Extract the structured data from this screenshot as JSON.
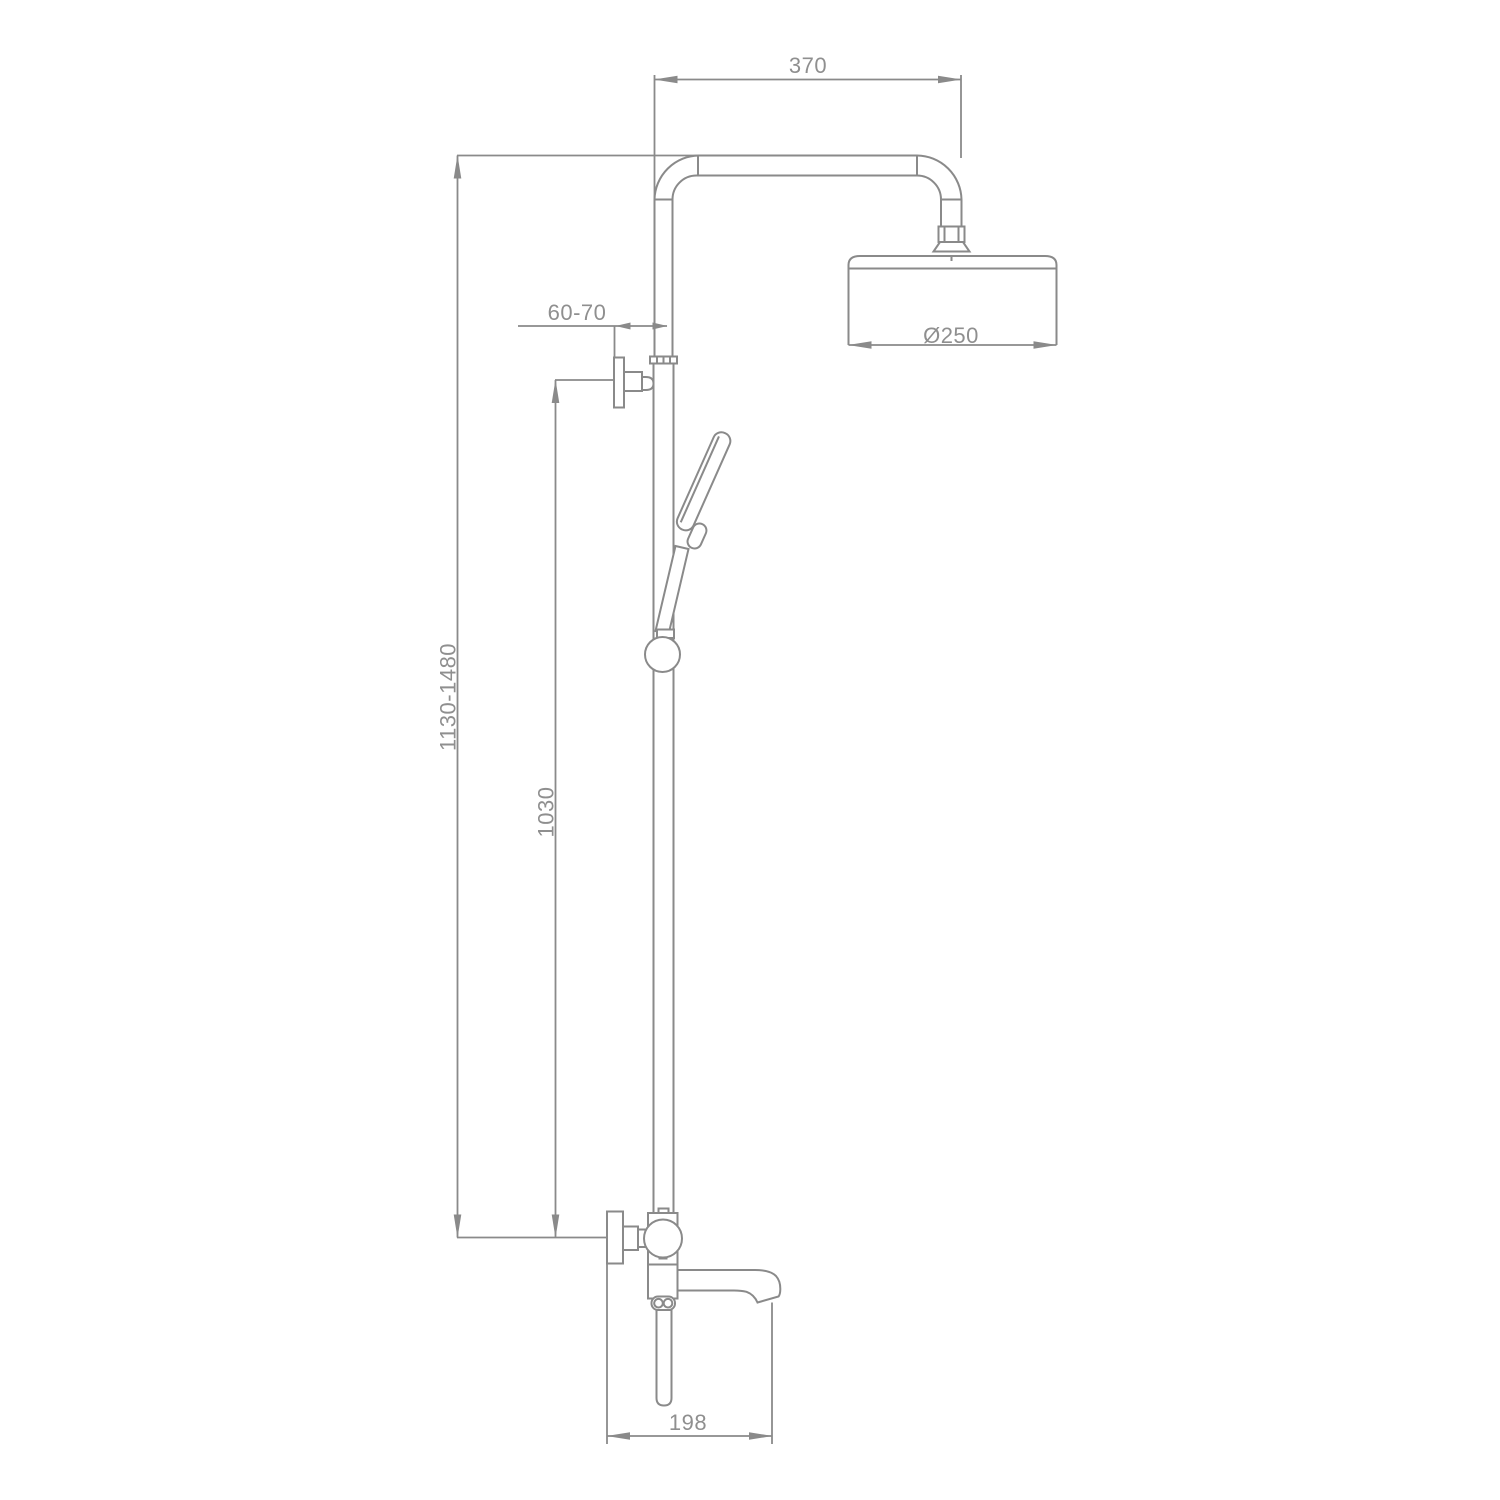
{
  "theme": {
    "background": "#ffffff",
    "line_color": "#8a8a8a",
    "text_color": "#8f8f8f"
  },
  "dims": {
    "arm_reach": "370",
    "head_diameter": "Ø250",
    "wall_offset": "60-70",
    "column_height": "1130-1480",
    "rail_height": "1030",
    "spout_reach": "198"
  }
}
